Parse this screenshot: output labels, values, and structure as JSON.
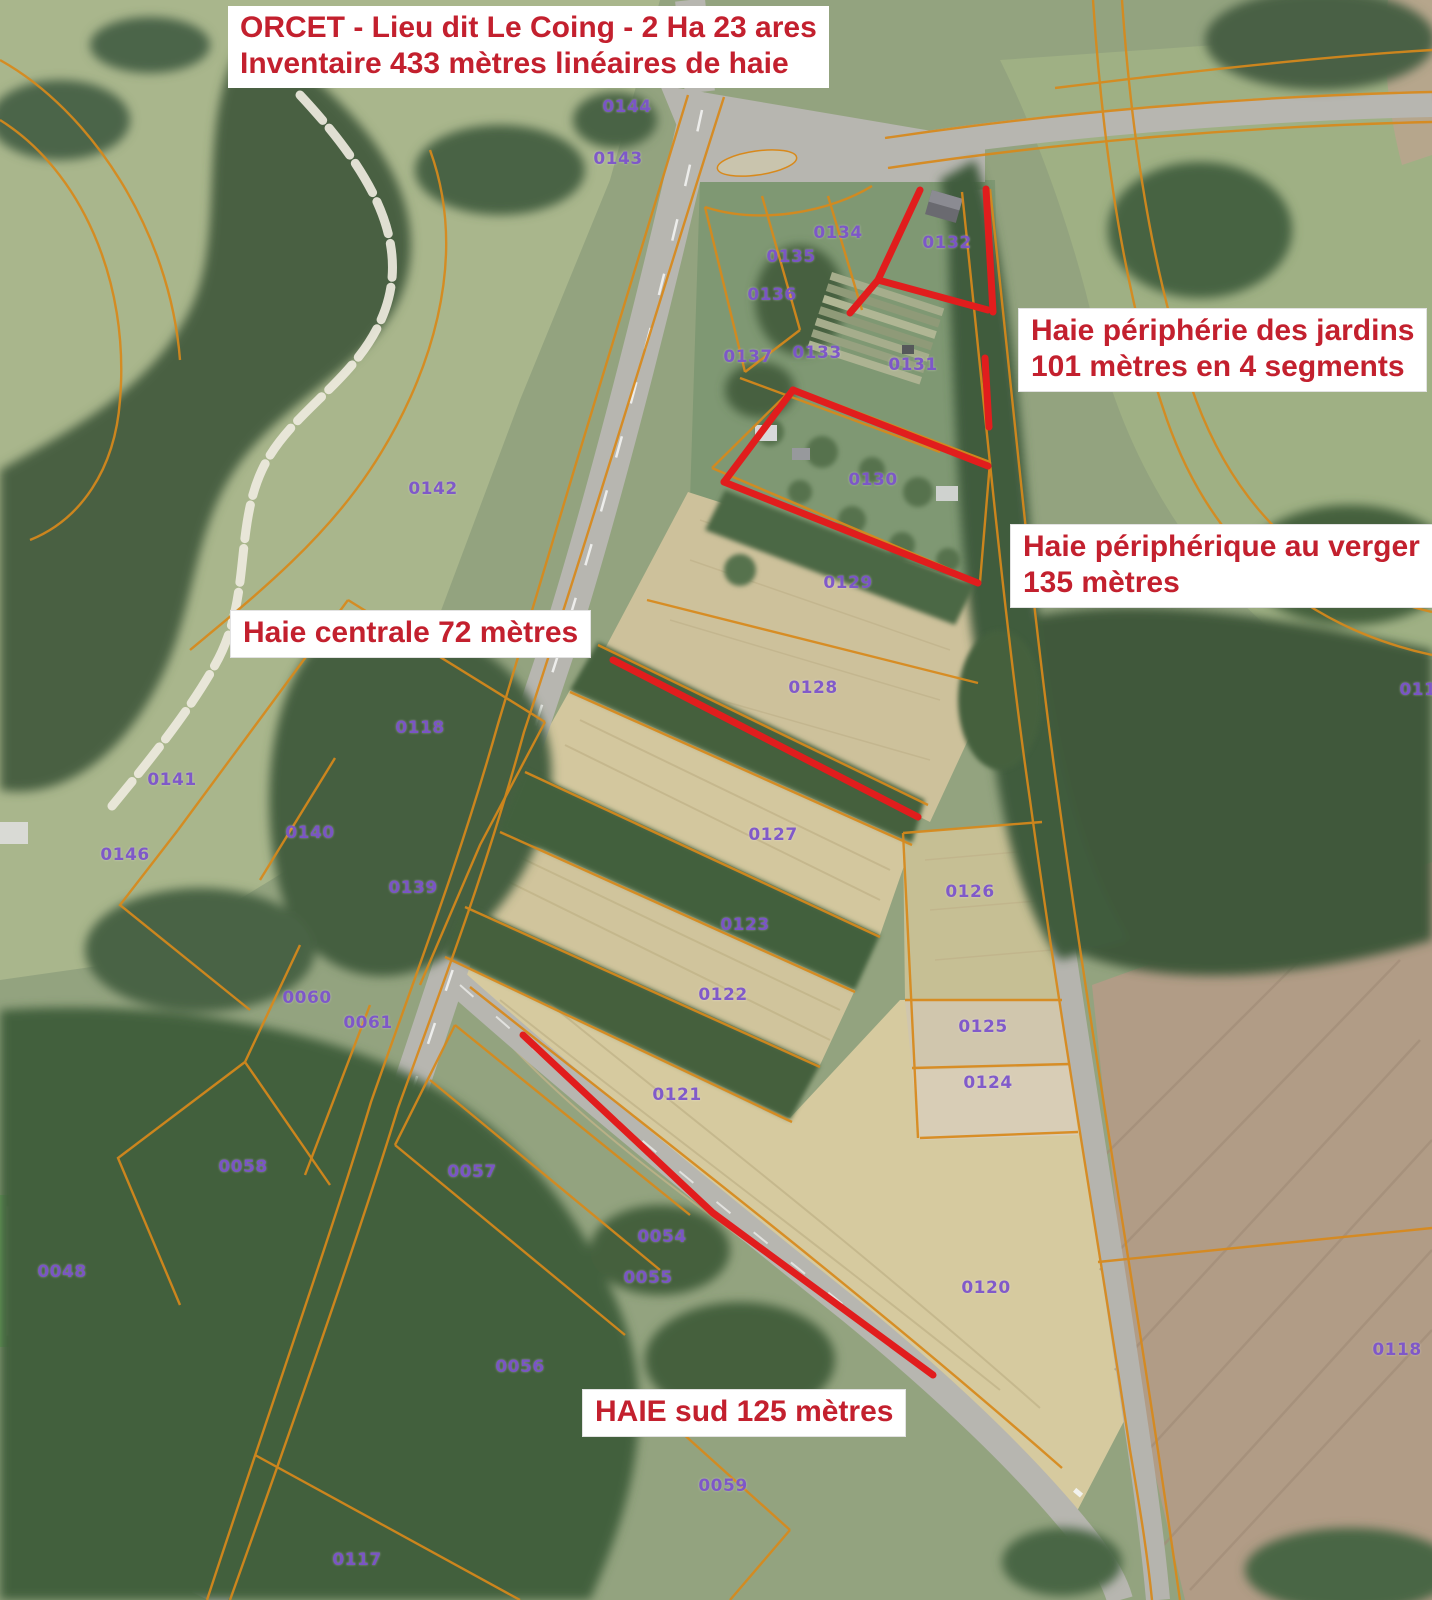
{
  "map": {
    "title": {
      "line1": "ORCET - Lieu dit Le Coing - 2 Ha 23 ares",
      "line2": "Inventaire 433 mètres linéaires de haie"
    },
    "annotations": {
      "jardins": {
        "line1": "Haie périphérie des jardins",
        "line2": "101 mètres en 4 segments"
      },
      "verger": {
        "line1": "Haie périphérique au verger",
        "line2": "135 mètres"
      },
      "centrale": {
        "label": "Haie centrale 72 mètres"
      },
      "sud": {
        "label": "HAIE sud 125 mètres"
      }
    },
    "colors": {
      "annotation_text": "#c3202e",
      "hedge_line": "#e11d1d",
      "parcel_line": "#d8891b",
      "parcel_label": "#7d55cc"
    },
    "parcels": [
      {
        "n": "0144",
        "x": 627,
        "y": 107
      },
      {
        "n": "0143",
        "x": 618,
        "y": 159
      },
      {
        "n": "0134",
        "x": 838,
        "y": 233
      },
      {
        "n": "0132",
        "x": 947,
        "y": 243
      },
      {
        "n": "0135",
        "x": 791,
        "y": 257
      },
      {
        "n": "0136",
        "x": 772,
        "y": 295
      },
      {
        "n": "0137",
        "x": 748,
        "y": 357
      },
      {
        "n": "0133",
        "x": 817,
        "y": 353
      },
      {
        "n": "0131",
        "x": 913,
        "y": 365
      },
      {
        "n": "0142",
        "x": 433,
        "y": 489
      },
      {
        "n": "0130",
        "x": 873,
        "y": 480
      },
      {
        "n": "0129",
        "x": 848,
        "y": 583
      },
      {
        "n": "0128",
        "x": 813,
        "y": 688
      },
      {
        "n": "0118",
        "x": 420,
        "y": 728
      },
      {
        "n": "0141",
        "x": 172,
        "y": 780
      },
      {
        "n": "0140",
        "x": 310,
        "y": 833
      },
      {
        "n": "0146",
        "x": 125,
        "y": 855
      },
      {
        "n": "0139",
        "x": 413,
        "y": 888
      },
      {
        "n": "0127",
        "x": 773,
        "y": 835
      },
      {
        "n": "0126",
        "x": 970,
        "y": 892
      },
      {
        "n": "0123",
        "x": 745,
        "y": 925
      },
      {
        "n": "0122",
        "x": 723,
        "y": 995
      },
      {
        "n": "0060",
        "x": 307,
        "y": 998
      },
      {
        "n": "0061",
        "x": 368,
        "y": 1023
      },
      {
        "n": "0125",
        "x": 983,
        "y": 1027
      },
      {
        "n": "0124",
        "x": 988,
        "y": 1083
      },
      {
        "n": "0121",
        "x": 677,
        "y": 1095
      },
      {
        "n": "0058",
        "x": 243,
        "y": 1167
      },
      {
        "n": "0057",
        "x": 472,
        "y": 1172
      },
      {
        "n": "0054",
        "x": 662,
        "y": 1237
      },
      {
        "n": "0048",
        "x": 62,
        "y": 1272
      },
      {
        "n": "0055",
        "x": 648,
        "y": 1278
      },
      {
        "n": "0120",
        "x": 986,
        "y": 1288
      },
      {
        "n": "0119",
        "x": 1424,
        "y": 690
      },
      {
        "n": "0118",
        "x": 1397,
        "y": 1350
      },
      {
        "n": "0056",
        "x": 520,
        "y": 1367
      },
      {
        "n": "0059",
        "x": 723,
        "y": 1486
      },
      {
        "n": "0117",
        "x": 357,
        "y": 1560
      }
    ],
    "hedge_lines": [
      {
        "name": "jardins-ouest",
        "points": [
          [
            920,
            190
          ],
          [
            878,
            280
          ],
          [
            850,
            313
          ]
        ]
      },
      {
        "name": "jardins-centre",
        "points": [
          [
            878,
            280
          ],
          [
            988,
            310
          ]
        ]
      },
      {
        "name": "jardins-est-haut",
        "points": [
          [
            986,
            189
          ],
          [
            993,
            312
          ]
        ]
      },
      {
        "name": "jardins-est-bas",
        "points": [
          [
            985,
            358
          ],
          [
            989,
            427
          ]
        ]
      },
      {
        "name": "verger-nord",
        "points": [
          [
            793,
            390
          ],
          [
            988,
            466
          ]
        ]
      },
      {
        "name": "verger-ouest",
        "points": [
          [
            793,
            390
          ],
          [
            724,
            482
          ]
        ]
      },
      {
        "name": "verger-sud",
        "points": [
          [
            724,
            482
          ],
          [
            978,
            583
          ]
        ]
      },
      {
        "name": "centrale",
        "points": [
          [
            613,
            660
          ],
          [
            918,
            817
          ]
        ]
      },
      {
        "name": "sud",
        "points": [
          [
            523,
            1035
          ],
          [
            713,
            1213
          ],
          [
            933,
            1375
          ]
        ]
      }
    ]
  }
}
